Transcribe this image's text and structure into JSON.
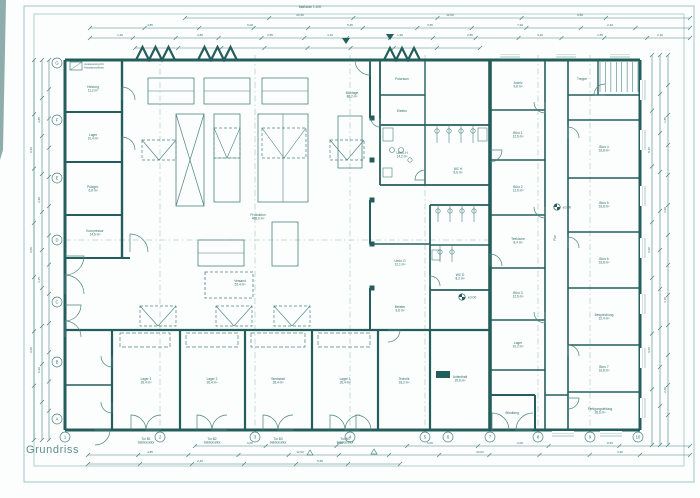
{
  "title_block": {
    "title": "Grundriss"
  },
  "sheet_note": "Maßstab 1:100",
  "colors": {
    "ink": "#4a827f",
    "wall": "#245e5c",
    "light": "#8db4b1",
    "micro": "#2f6a67",
    "paper": "#fcfefd"
  },
  "frame": {
    "outer": [
      24,
      6,
      670,
      476
    ],
    "inner": [
      34,
      14,
      650,
      452
    ]
  },
  "legend": {
    "box": [
      70,
      62,
      12,
      8
    ],
    "x": 94,
    "y": 65,
    "lines": [
      "Aussparung für",
      "Hausanschluss"
    ]
  },
  "grid": {
    "row_labels": [
      "G",
      "F",
      "E",
      "D",
      "C",
      "B",
      "A"
    ],
    "row_y": [
      63,
      120,
      178,
      240,
      302,
      362,
      419
    ],
    "row_x": 57,
    "col_labels": [
      "1",
      "2",
      "3",
      "4",
      "5",
      "6",
      "7",
      "8",
      "9",
      "10"
    ],
    "col_x": [
      65,
      160,
      255,
      350,
      425,
      448,
      490,
      538,
      590,
      638
    ],
    "col_y": 437
  },
  "walls": [
    [
      65,
      60,
      640,
      60,
      3
    ],
    [
      640,
      60,
      640,
      430,
      3
    ],
    [
      65,
      430,
      640,
      430,
      3
    ],
    [
      65,
      60,
      65,
      430,
      3
    ],
    [
      490,
      60,
      490,
      430,
      3.6
    ],
    [
      122,
      60,
      122,
      258,
      2.4
    ],
    [
      65,
      112,
      122,
      112,
      2
    ],
    [
      65,
      162,
      122,
      162,
      2
    ],
    [
      65,
      215,
      122,
      215,
      2
    ],
    [
      65,
      258,
      130,
      258,
      2
    ],
    [
      65,
      330,
      490,
      330,
      2.2
    ],
    [
      112,
      330,
      112,
      430,
      2.2
    ],
    [
      180,
      330,
      180,
      430,
      2.2
    ],
    [
      245,
      330,
      245,
      430,
      2.2
    ],
    [
      312,
      330,
      312,
      430,
      2.2
    ],
    [
      378,
      330,
      378,
      430,
      2.2
    ],
    [
      430,
      330,
      430,
      430,
      2.2
    ],
    [
      65,
      385,
      112,
      385,
      1.6
    ],
    [
      535,
      395,
      535,
      430,
      2
    ],
    [
      490,
      395,
      535,
      395,
      2
    ],
    [
      370,
      60,
      370,
      118,
      2
    ],
    [
      370,
      200,
      370,
      244,
      2
    ],
    [
      370,
      288,
      370,
      330,
      2
    ],
    [
      380,
      125,
      490,
      125,
      1.8
    ],
    [
      380,
      185,
      490,
      185,
      1.8
    ],
    [
      380,
      125,
      380,
      185,
      1.8
    ],
    [
      425,
      125,
      425,
      185,
      1.4
    ],
    [
      380,
      95,
      425,
      95,
      1.4
    ],
    [
      380,
      60,
      380,
      125,
      1.8
    ],
    [
      425,
      60,
      425,
      125,
      1.4
    ],
    [
      430,
      205,
      490,
      205,
      1.8
    ],
    [
      430,
      290,
      490,
      290,
      1.8
    ],
    [
      430,
      205,
      430,
      290,
      1.8
    ],
    [
      430,
      245,
      490,
      245,
      1.4
    ],
    [
      370,
      244,
      430,
      244,
      1.4
    ],
    [
      430,
      290,
      430,
      330,
      1.8
    ],
    [
      545,
      60,
      545,
      430,
      1.6
    ],
    [
      568,
      60,
      568,
      430,
      1.6
    ],
    [
      490,
      110,
      545,
      110,
      1.4
    ],
    [
      490,
      160,
      545,
      160,
      1.4
    ],
    [
      490,
      215,
      545,
      215,
      1.4
    ],
    [
      490,
      268,
      545,
      268,
      1.4
    ],
    [
      490,
      320,
      545,
      320,
      1.4
    ],
    [
      490,
      370,
      545,
      370,
      1.4
    ],
    [
      568,
      120,
      640,
      120,
      1.4
    ],
    [
      568,
      178,
      640,
      178,
      1.4
    ],
    [
      568,
      232,
      640,
      232,
      1.4
    ],
    [
      568,
      288,
      640,
      288,
      1.4
    ],
    [
      568,
      345,
      640,
      345,
      1.4
    ],
    [
      568,
      392,
      640,
      392,
      1.4
    ],
    [
      545,
      395,
      568,
      395,
      1.4
    ],
    [
      598,
      60,
      598,
      95,
      1.4
    ],
    [
      568,
      95,
      640,
      95,
      1.4
    ]
  ],
  "machines": [
    [
      "h",
      148,
      78,
      46,
      26
    ],
    [
      "h",
      204,
      78,
      46,
      26
    ],
    [
      "h",
      262,
      78,
      46,
      26
    ],
    [
      "x",
      176,
      114,
      28,
      92
    ],
    [
      "h",
      214,
      114,
      26,
      88
    ],
    [
      "v",
      258,
      114,
      50,
      88
    ],
    [
      "p",
      338,
      116,
      24,
      52
    ],
    [
      "h",
      198,
      240,
      46,
      26
    ],
    [
      "p",
      272,
      222,
      26,
      44
    ],
    [
      "d",
      205,
      272,
      48,
      26
    ]
  ],
  "vents": [
    [
      142,
      140,
      34,
      20
    ],
    [
      330,
      140,
      34,
      20
    ],
    [
      140,
      306,
      36,
      20
    ],
    [
      216,
      306,
      36,
      20
    ],
    [
      274,
      306,
      36,
      20
    ]
  ],
  "overlays": [
    [
      214,
      128,
      26,
      30
    ],
    [
      262,
      128,
      44,
      30
    ]
  ],
  "sawtooth": [
    {
      "x": 136,
      "n": 3,
      "w": 13,
      "h": 13
    },
    {
      "x": 198,
      "n": 3,
      "w": 13,
      "h": 13
    },
    {
      "x": 384,
      "n": 3,
      "w": 12,
      "h": 12
    }
  ],
  "columns": [
    [
      372,
      118
    ],
    [
      372,
      160
    ],
    [
      372,
      200
    ],
    [
      372,
      244
    ],
    [
      372,
      288
    ]
  ],
  "stairs": {
    "x": 600,
    "y": 62,
    "w": 38,
    "h": 30,
    "n": 8
  },
  "doors": [
    [
      122,
      100,
      13,
      270
    ],
    [
      122,
      150,
      13,
      270
    ],
    [
      130,
      252,
      18,
      270
    ],
    [
      65,
      256,
      19,
      0
    ],
    [
      65,
      294,
      19,
      270
    ],
    [
      65,
      305,
      16,
      0
    ],
    [
      65,
      337,
      16,
      270
    ],
    [
      112,
      356,
      11,
      90
    ],
    [
      112,
      402,
      11,
      90
    ],
    [
      95,
      430,
      15,
      0
    ],
    [
      131,
      430,
      15,
      270
    ],
    [
      161,
      430,
      15,
      180
    ],
    [
      197,
      430,
      15,
      270
    ],
    [
      227,
      430,
      15,
      180
    ],
    [
      263,
      430,
      15,
      270
    ],
    [
      293,
      430,
      15,
      180
    ],
    [
      330,
      430,
      15,
      270
    ],
    [
      360,
      430,
      15,
      180
    ],
    [
      356,
      430,
      15,
      270
    ],
    [
      492,
      430,
      17,
      270
    ],
    [
      533,
      430,
      17,
      180
    ],
    [
      388,
      330,
      12,
      0
    ],
    [
      490,
      150,
      12,
      0
    ],
    [
      490,
      266,
      12,
      270
    ],
    [
      545,
      102,
      11,
      90
    ],
    [
      545,
      207,
      11,
      90
    ],
    [
      545,
      312,
      11,
      90
    ],
    [
      568,
      138,
      11,
      270
    ],
    [
      568,
      248,
      11,
      270
    ],
    [
      568,
      356,
      11,
      270
    ],
    [
      568,
      398,
      11,
      0
    ],
    [
      425,
      180,
      10,
      180
    ],
    [
      430,
      286,
      10,
      270
    ],
    [
      380,
      118,
      9,
      90
    ],
    [
      370,
      60,
      15,
      90
    ],
    [
      605,
      95,
      11,
      180
    ]
  ],
  "windows": [
    {
      "o": "v",
      "x": 641,
      "y": 80,
      "len": 20
    },
    {
      "o": "v",
      "x": 641,
      "y": 130,
      "len": 20
    },
    {
      "o": "v",
      "x": 641,
      "y": 186,
      "len": 20
    },
    {
      "o": "v",
      "x": 641,
      "y": 238,
      "len": 20
    },
    {
      "o": "v",
      "x": 641,
      "y": 294,
      "len": 20
    },
    {
      "o": "v",
      "x": 641,
      "y": 348,
      "len": 20
    },
    {
      "o": "v",
      "x": 641,
      "y": 398,
      "len": 20
    },
    {
      "o": "h",
      "x": 552,
      "y": 432,
      "len": 22
    },
    {
      "o": "h",
      "x": 600,
      "y": 432,
      "len": 22
    },
    {
      "o": "h",
      "x": 500,
      "y": 53,
      "len": 20
    },
    {
      "o": "h",
      "x": 556,
      "y": 53,
      "len": 20
    },
    {
      "o": "h",
      "x": 610,
      "y": 53,
      "len": 20
    }
  ],
  "bay_lofts": [
    [
      120,
      333,
      50,
      14
    ],
    [
      186,
      333,
      52,
      14
    ],
    [
      251,
      333,
      54,
      14
    ],
    [
      318,
      333,
      52,
      14
    ]
  ],
  "fixture_circles": [
    [
      392,
      150,
      2.5
    ],
    [
      401,
      150,
      2.5
    ],
    [
      437,
      131,
      2.2
    ],
    [
      449,
      131,
      2.2
    ],
    [
      461,
      131,
      2.2
    ],
    [
      473,
      131,
      2.2
    ],
    [
      438,
      211,
      2.2
    ],
    [
      450,
      211,
      2.2
    ],
    [
      462,
      211,
      2.2
    ],
    [
      474,
      211,
      2.2
    ],
    [
      440,
      252,
      2.2
    ],
    [
      452,
      252,
      2.2
    ],
    [
      410,
      160,
      2.2
    ]
  ],
  "fixture_rects": [
    [
      383,
      128,
      10,
      13
    ],
    [
      478,
      128,
      9,
      13
    ],
    [
      383,
      168,
      9,
      9
    ],
    [
      432,
      250,
      8,
      10
    ]
  ],
  "solid_rects": [
    [
      436,
      371,
      14,
      7
    ]
  ],
  "stall_lines": [
    [
      437,
      125,
      437,
      143
    ],
    [
      449,
      125,
      449,
      143
    ],
    [
      461,
      125,
      461,
      143
    ],
    [
      473,
      125,
      473,
      143
    ],
    [
      438,
      205,
      438,
      222
    ],
    [
      450,
      205,
      450,
      222
    ],
    [
      462,
      205,
      462,
      222
    ],
    [
      474,
      205,
      474,
      222
    ],
    [
      440,
      245,
      440,
      262
    ],
    [
      452,
      245,
      452,
      262
    ]
  ],
  "dash_axes": [
    {
      "o": "v",
      "p": 160
    },
    {
      "o": "v",
      "p": 255
    },
    {
      "o": "v",
      "p": 350
    },
    {
      "o": "v",
      "p": 425
    },
    {
      "o": "v",
      "p": 538
    },
    {
      "o": "v",
      "p": 590
    },
    {
      "o": "h",
      "p": 240
    }
  ],
  "dims": [
    {
      "x1": 185,
      "y1": 18,
      "x2": 690,
      "y2": 18,
      "n": 6
    },
    {
      "x1": 90,
      "y1": 28,
      "x2": 690,
      "y2": 28,
      "n": 11
    },
    {
      "x1": 90,
      "y1": 38,
      "x2": 690,
      "y2": 38,
      "n": 14
    },
    {
      "x1": 135,
      "y1": 48,
      "x2": 480,
      "y2": 48,
      "n": 8
    },
    {
      "x1": 195,
      "y1": 446,
      "x2": 690,
      "y2": 446,
      "n": 7
    },
    {
      "x1": 88,
      "y1": 455,
      "x2": 690,
      "y2": 455,
      "n": 12
    },
    {
      "x1": 88,
      "y1": 464,
      "x2": 400,
      "y2": 464,
      "n": 6
    },
    {
      "x1": 34,
      "y1": 60,
      "x2": 34,
      "y2": 440,
      "n": 7
    },
    {
      "x1": 42,
      "y1": 60,
      "x2": 42,
      "y2": 440,
      "n": 10
    },
    {
      "x1": 49,
      "y1": 60,
      "x2": 49,
      "y2": 440,
      "n": 13
    },
    {
      "x1": 652,
      "y1": 55,
      "x2": 652,
      "y2": 445,
      "n": 7
    },
    {
      "x1": 660,
      "y1": 55,
      "x2": 660,
      "y2": 445,
      "n": 10
    },
    {
      "x1": 668,
      "y1": 55,
      "x2": 668,
      "y2": 445,
      "n": 13
    }
  ],
  "dim_labels": [
    {
      "t": "24,36",
      "x": 300,
      "y": 16
    },
    {
      "t": "12,00",
      "x": 450,
      "y": 16
    },
    {
      "t": "9,80",
      "x": 580,
      "y": 16
    },
    {
      "t": "4,85",
      "x": 150,
      "y": 26
    },
    {
      "t": "6,00",
      "x": 250,
      "y": 26
    },
    {
      "t": "5,45",
      "x": 350,
      "y": 26
    },
    {
      "t": "3,65",
      "x": 430,
      "y": 26
    },
    {
      "t": "7,20",
      "x": 520,
      "y": 26
    },
    {
      "t": "2,40",
      "x": 610,
      "y": 26
    },
    {
      "t": "1,20",
      "x": 120,
      "y": 36
    },
    {
      "t": "3,80",
      "x": 200,
      "y": 36
    },
    {
      "t": "2,55",
      "x": 270,
      "y": 36
    },
    {
      "t": "4,10",
      "x": 330,
      "y": 36
    },
    {
      "t": "1,90",
      "x": 400,
      "y": 36
    },
    {
      "t": "2,85",
      "x": 470,
      "y": 36
    },
    {
      "t": "3,40",
      "x": 540,
      "y": 36
    },
    {
      "t": "1,55",
      "x": 600,
      "y": 36
    },
    {
      "t": "2,10",
      "x": 660,
      "y": 36
    },
    {
      "t": "6,00",
      "x": 250,
      "y": 444
    },
    {
      "t": "6,00",
      "x": 340,
      "y": 444
    },
    {
      "t": "6,00",
      "x": 430,
      "y": 444
    },
    {
      "t": "6,00",
      "x": 520,
      "y": 444
    },
    {
      "t": "8,45",
      "x": 610,
      "y": 444
    },
    {
      "t": "4,85",
      "x": 150,
      "y": 453
    },
    {
      "t": "12,50",
      "x": 300,
      "y": 453
    },
    {
      "t": "24,00",
      "x": 480,
      "y": 453
    },
    {
      "t": "3,20",
      "x": 620,
      "y": 453
    },
    {
      "t": "2,40",
      "x": 200,
      "y": 462
    },
    {
      "t": "5,65",
      "x": 320,
      "y": 462
    },
    {
      "t": "8,40",
      "x": 32,
      "y": 150,
      "r": -90
    },
    {
      "t": "6,00",
      "x": 32,
      "y": 250,
      "r": -90
    },
    {
      "t": "9,60",
      "x": 32,
      "y": 350,
      "r": -90
    },
    {
      "t": "3,85",
      "x": 40,
      "y": 120,
      "r": -90
    },
    {
      "t": "2,90",
      "x": 40,
      "y": 200,
      "r": -90
    },
    {
      "t": "4,15",
      "x": 40,
      "y": 280,
      "r": -90
    },
    {
      "t": "5,20",
      "x": 40,
      "y": 370,
      "r": -90
    },
    {
      "t": "8,40",
      "x": 650,
      "y": 150,
      "r": -90
    },
    {
      "t": "6,00",
      "x": 650,
      "y": 250,
      "r": -90
    },
    {
      "t": "9,60",
      "x": 650,
      "y": 350,
      "r": -90
    },
    {
      "t": "1,85",
      "x": 666,
      "y": 120,
      "r": -90
    },
    {
      "t": "2,90",
      "x": 666,
      "y": 210,
      "r": -90
    },
    {
      "t": "3,15",
      "x": 666,
      "y": 300,
      "r": -90
    },
    {
      "t": "2,60",
      "x": 666,
      "y": 390,
      "r": -90
    }
  ],
  "room_labels": [
    {
      "t": [
        "Heizung",
        "11,2 m²"
      ],
      "x": 93,
      "y": 88
    },
    {
      "t": [
        "Lager",
        "10,4 m²"
      ],
      "x": 93,
      "y": 136
    },
    {
      "t": [
        "Putzger.",
        "6,8 m²"
      ],
      "x": 93,
      "y": 188
    },
    {
      "t": [
        "Kompressor",
        "14,6 m²"
      ],
      "x": 95,
      "y": 232
    },
    {
      "t": [
        "Produktion",
        "468,0 m²"
      ],
      "x": 258,
      "y": 216
    },
    {
      "t": [
        "Montage",
        "86,2 m²"
      ],
      "x": 352,
      "y": 94
    },
    {
      "t": [
        "Versand",
        "52,4 m²"
      ],
      "x": 240,
      "y": 282
    },
    {
      "t": [
        "Umkl. H",
        "14,2 m²"
      ],
      "x": 402,
      "y": 154
    },
    {
      "t": [
        "WC H",
        "8,6 m²"
      ],
      "x": 458,
      "y": 170
    },
    {
      "t": [
        "Umkl. D",
        "12,1 m²"
      ],
      "x": 400,
      "y": 262
    },
    {
      "t": [
        "WC D",
        "8,2 m²"
      ],
      "x": 460,
      "y": 276
    },
    {
      "t": [
        "Putzraum"
      ],
      "x": 402,
      "y": 80
    },
    {
      "t": [
        "Elektro"
      ],
      "x": 402,
      "y": 112
    },
    {
      "t": [
        "Meister",
        "9,6 m²"
      ],
      "x": 400,
      "y": 308
    },
    {
      "t": [
        "Lager 1",
        "26,4 m²"
      ],
      "x": 146,
      "y": 380
    },
    {
      "t": [
        "Lager 2",
        "26,4 m²"
      ],
      "x": 212,
      "y": 380
    },
    {
      "t": [
        "Werkstatt",
        "26,4 m²"
      ],
      "x": 278,
      "y": 380
    },
    {
      "t": [
        "Lager 3",
        "26,4 m²"
      ],
      "x": 345,
      "y": 380
    },
    {
      "t": [
        "Technik",
        "18,2 m²"
      ],
      "x": 404,
      "y": 380
    },
    {
      "t": [
        "Aufenthalt",
        "20,6 m²"
      ],
      "x": 460,
      "y": 378
    },
    {
      "t": [
        "Windfang"
      ],
      "x": 512,
      "y": 414
    },
    {
      "t": [
        "Archiv",
        "9,8 m²"
      ],
      "x": 518,
      "y": 84
    },
    {
      "t": [
        "Büro 1",
        "12,6 m²"
      ],
      "x": 518,
      "y": 134
    },
    {
      "t": [
        "Büro 2",
        "12,6 m²"
      ],
      "x": 518,
      "y": 188
    },
    {
      "t": [
        "Teeküche",
        "8,4 m²"
      ],
      "x": 518,
      "y": 240
    },
    {
      "t": [
        "Büro 3",
        "12,6 m²"
      ],
      "x": 518,
      "y": 294
    },
    {
      "t": [
        "Lager",
        "10,2 m²"
      ],
      "x": 518,
      "y": 344
    },
    {
      "t": [
        "Treppe"
      ],
      "x": 582,
      "y": 80
    },
    {
      "t": [
        "Büro 4",
        "16,8 m²"
      ],
      "x": 604,
      "y": 148
    },
    {
      "t": [
        "Büro 5",
        "16,8 m²"
      ],
      "x": 604,
      "y": 204
    },
    {
      "t": [
        "Büro 6",
        "16,8 m²"
      ],
      "x": 604,
      "y": 260
    },
    {
      "t": [
        "Besprechung",
        "22,4 m²"
      ],
      "x": 604,
      "y": 316
    },
    {
      "t": [
        "Büro 7",
        "16,8 m²"
      ],
      "x": 604,
      "y": 368
    },
    {
      "t": [
        "Fertigungsleitung",
        "28,6 m²"
      ],
      "x": 600,
      "y": 410
    },
    {
      "t": [
        "Flur"
      ],
      "x": 556,
      "y": 238,
      "r": -90
    }
  ],
  "door_labels": [
    {
      "t": [
        "Tor B1",
        "Sektionaltor"
      ],
      "x": 146,
      "y": 440
    },
    {
      "t": [
        "Tor B2",
        "Sektionaltor"
      ],
      "x": 212,
      "y": 440
    },
    {
      "t": [
        "Tor B3",
        "Sektionaltor"
      ],
      "x": 278,
      "y": 440
    },
    {
      "t": [
        "Tor B4",
        "Sektionaltor"
      ],
      "x": 345,
      "y": 440
    }
  ],
  "levels": [
    {
      "x": 557,
      "y": 207,
      "t": "±0.00"
    },
    {
      "x": 462,
      "y": 297,
      "t": "±0.00"
    }
  ],
  "datum_triangles": [
    [
      346,
      42
    ],
    [
      390,
      38
    ]
  ],
  "open_triangles": [
    [
      310,
      452
    ],
    [
      374,
      451
    ]
  ]
}
